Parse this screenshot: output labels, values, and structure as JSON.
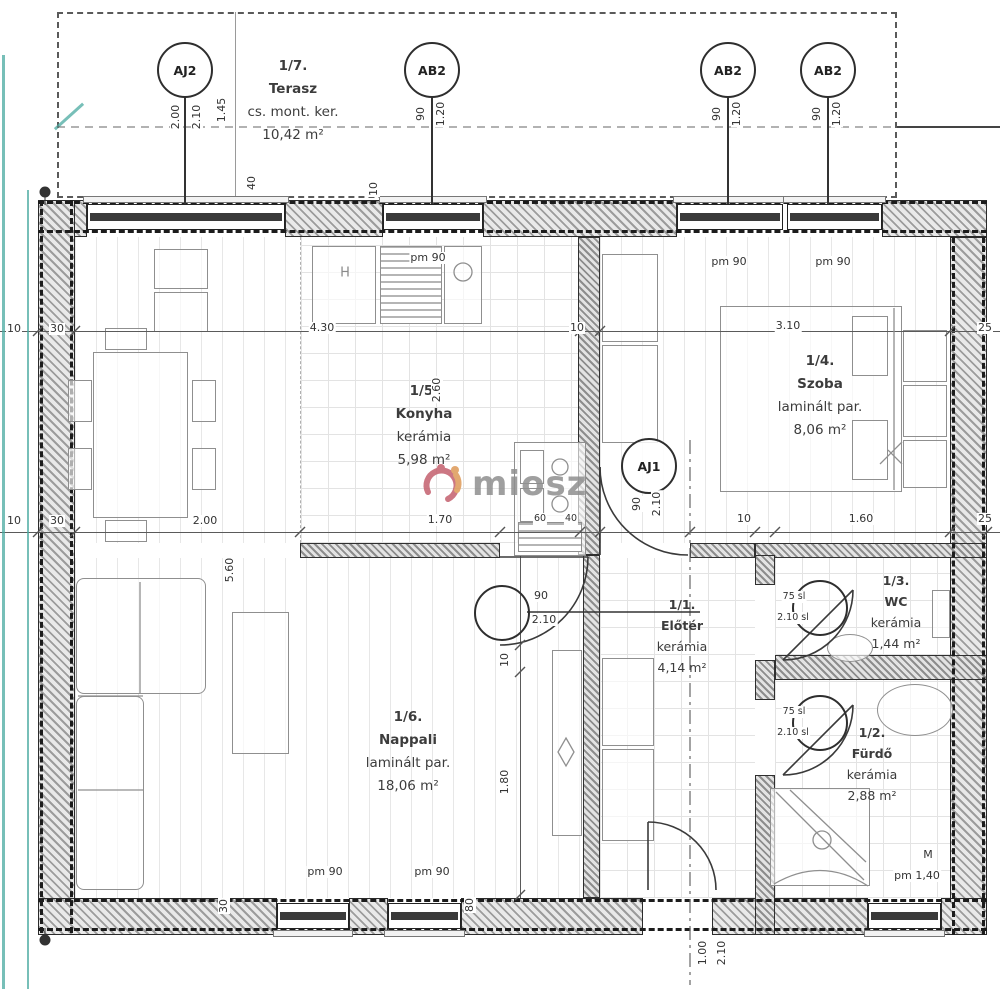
{
  "watermark": {
    "brand": "miosz"
  },
  "rooms": [
    {
      "id": "terasz",
      "number": "1/7.",
      "name": "Terasz",
      "finish": "cs. mont. ker.",
      "area": "10,42 m²",
      "x": 293,
      "y": 55,
      "small": false
    },
    {
      "id": "konyha",
      "number": "1/5.",
      "name": "Konyha",
      "finish": "kerámia",
      "area": "5,98 m²",
      "x": 424,
      "y": 380,
      "small": false
    },
    {
      "id": "szoba",
      "number": "1/4.",
      "name": "Szoba",
      "finish": "laminált par.",
      "area": "8,06 m²",
      "x": 820,
      "y": 350,
      "small": false
    },
    {
      "id": "nappali",
      "number": "1/6.",
      "name": "Nappali",
      "finish": "laminált par.",
      "area": "18,06 m²",
      "x": 408,
      "y": 706,
      "small": false
    },
    {
      "id": "eloter",
      "number": "1/1.",
      "name": "Előtér",
      "finish": "kerámia",
      "area": "4,14 m²",
      "x": 682,
      "y": 594,
      "small": true
    },
    {
      "id": "wc",
      "number": "1/3.",
      "name": "WC",
      "finish": "kerámia",
      "area": "1,44 m²",
      "x": 896,
      "y": 570,
      "small": true
    },
    {
      "id": "furdo",
      "number": "1/2.",
      "name": "Fürdő",
      "finish": "kerámia",
      "area": "2,88 m²",
      "x": 872,
      "y": 722,
      "small": true
    }
  ],
  "tags": [
    {
      "label": "AJ2",
      "x": 185,
      "y": 70,
      "stem": 1
    },
    {
      "label": "AB2",
      "x": 432,
      "y": 70,
      "stem": 1
    },
    {
      "label": "AB2",
      "x": 728,
      "y": 70,
      "stem": 1
    },
    {
      "label": "AB2",
      "x": 828,
      "y": 70,
      "stem": 1
    },
    {
      "label": "AJ1",
      "x": 649,
      "y": 466,
      "stem": 0
    },
    {
      "label": "",
      "x": 502,
      "y": 613,
      "stem": 0
    },
    {
      "label": "",
      "x": 820,
      "y": 608,
      "stem": 0
    },
    {
      "label": "",
      "x": 820,
      "y": 723,
      "stem": 0
    }
  ],
  "dim_labels": [
    {
      "t": "1.45",
      "x": 222,
      "y": 110,
      "r": 1
    },
    {
      "t": "2.00",
      "x": 176,
      "y": 117,
      "r": 1
    },
    {
      "t": "2.10",
      "x": 197,
      "y": 117,
      "r": 1
    },
    {
      "t": "90",
      "x": 421,
      "y": 114,
      "r": 1
    },
    {
      "t": "1.20",
      "x": 441,
      "y": 114,
      "r": 1
    },
    {
      "t": "90",
      "x": 717,
      "y": 114,
      "r": 1
    },
    {
      "t": "1.20",
      "x": 737,
      "y": 114,
      "r": 1
    },
    {
      "t": "90",
      "x": 817,
      "y": 114,
      "r": 1
    },
    {
      "t": "1.20",
      "x": 837,
      "y": 114,
      "r": 1
    },
    {
      "t": "40",
      "x": 252,
      "y": 183,
      "r": 1
    },
    {
      "t": "10",
      "x": 374,
      "y": 189,
      "r": 1
    },
    {
      "t": "pm 90",
      "x": 428,
      "y": 258,
      "r": 0
    },
    {
      "t": "pm 90",
      "x": 729,
      "y": 262,
      "r": 0
    },
    {
      "t": "pm 90",
      "x": 833,
      "y": 262,
      "r": 0
    },
    {
      "t": "10",
      "x": 14,
      "y": 329,
      "r": 0
    },
    {
      "t": "30",
      "x": 57,
      "y": 329,
      "r": 0
    },
    {
      "t": "4.30",
      "x": 322,
      "y": 328,
      "r": 0
    },
    {
      "t": "10",
      "x": 577,
      "y": 328,
      "r": 0
    },
    {
      "t": "3.10",
      "x": 788,
      "y": 326,
      "r": 0
    },
    {
      "t": "25",
      "x": 985,
      "y": 328,
      "r": 0
    },
    {
      "t": "2.60",
      "x": 437,
      "y": 390,
      "r": 1
    },
    {
      "t": "10",
      "x": 14,
      "y": 521,
      "r": 0
    },
    {
      "t": "30",
      "x": 57,
      "y": 521,
      "r": 0
    },
    {
      "t": "2.00",
      "x": 205,
      "y": 521,
      "r": 0
    },
    {
      "t": "1.70",
      "x": 440,
      "y": 520,
      "r": 0
    },
    {
      "t": "60",
      "x": 540,
      "y": 519,
      "r": 0,
      "tiny": 1
    },
    {
      "t": "40",
      "x": 571,
      "y": 519,
      "r": 0,
      "tiny": 1
    },
    {
      "t": "90",
      "x": 637,
      "y": 504,
      "r": 1
    },
    {
      "t": "2.10",
      "x": 657,
      "y": 504,
      "r": 1
    },
    {
      "t": "10",
      "x": 744,
      "y": 519,
      "r": 0
    },
    {
      "t": "1.60",
      "x": 861,
      "y": 519,
      "r": 0
    },
    {
      "t": "25",
      "x": 985,
      "y": 519,
      "r": 0
    },
    {
      "t": "5.60",
      "x": 230,
      "y": 570,
      "r": 1
    },
    {
      "t": "10",
      "x": 505,
      "y": 660,
      "r": 1
    },
    {
      "t": "1.80",
      "x": 505,
      "y": 782,
      "r": 1
    },
    {
      "t": "90",
      "x": 541,
      "y": 596,
      "r": 0
    },
    {
      "t": "2.10",
      "x": 544,
      "y": 620,
      "r": 0
    },
    {
      "t": "75 sl",
      "x": 794,
      "y": 597,
      "r": 0,
      "tiny": 1
    },
    {
      "t": "2.10 sl",
      "x": 793,
      "y": 618,
      "r": 0,
      "tiny": 1
    },
    {
      "t": "75 sl",
      "x": 794,
      "y": 712,
      "r": 0,
      "tiny": 1
    },
    {
      "t": "2.10 sl",
      "x": 793,
      "y": 733,
      "r": 0,
      "tiny": 1
    },
    {
      "t": "pm 90",
      "x": 325,
      "y": 872,
      "r": 0
    },
    {
      "t": "pm 90",
      "x": 432,
      "y": 872,
      "r": 0
    },
    {
      "t": "M",
      "x": 928,
      "y": 855,
      "r": 0
    },
    {
      "t": "pm 1,40",
      "x": 917,
      "y": 876,
      "r": 0
    },
    {
      "t": "30",
      "x": 224,
      "y": 906,
      "r": 1
    },
    {
      "t": "80",
      "x": 470,
      "y": 905,
      "r": 1
    },
    {
      "t": "1.00",
      "x": 703,
      "y": 953,
      "r": 1
    },
    {
      "t": "2.10",
      "x": 722,
      "y": 953,
      "r": 1
    }
  ],
  "fixture_labels": [
    {
      "t": "H",
      "x": 345,
      "y": 273
    }
  ],
  "colors": {
    "teal": "#4aaaa0",
    "wm_red": "#c4606e",
    "wm_orange": "#de9a58",
    "wm_text": "#8f8f8f"
  }
}
